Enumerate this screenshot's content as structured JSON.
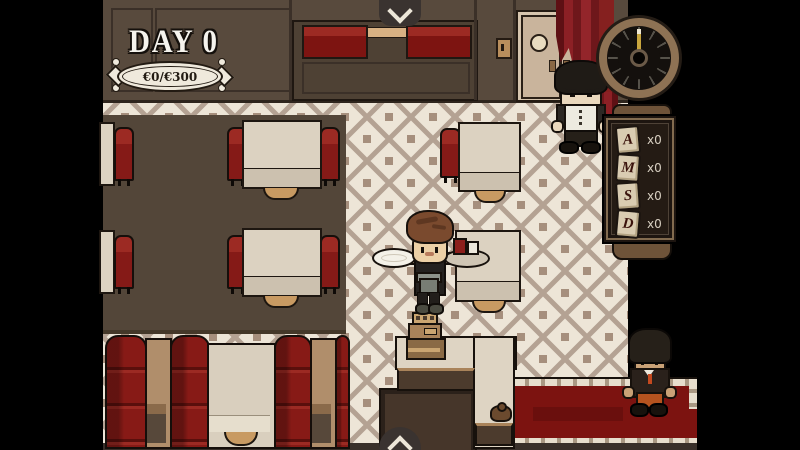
{
  "hud": {
    "day_label": "DAY 0",
    "money_progress": "€0/€300"
  },
  "menu_board": {
    "items": [
      {
        "letter": "A",
        "count": "x0"
      },
      {
        "letter": "M",
        "count": "x0"
      },
      {
        "letter": "S",
        "count": "x0"
      },
      {
        "letter": "D",
        "count": "x0"
      }
    ]
  },
  "colors": {
    "letterbox": "#000000",
    "wood": "#584a3d",
    "rug": "#534639",
    "wallpaper": "#ede5d7",
    "wallpaper_accent": "#b4a293",
    "booth_red": "#7c1411",
    "carpet_red": "#7c1310",
    "table_cream": "#dcd2c1",
    "clock_rim": "#8e7254",
    "curtain_red": "#8c2025",
    "clock_hand_gold": "#c9a63e"
  }
}
